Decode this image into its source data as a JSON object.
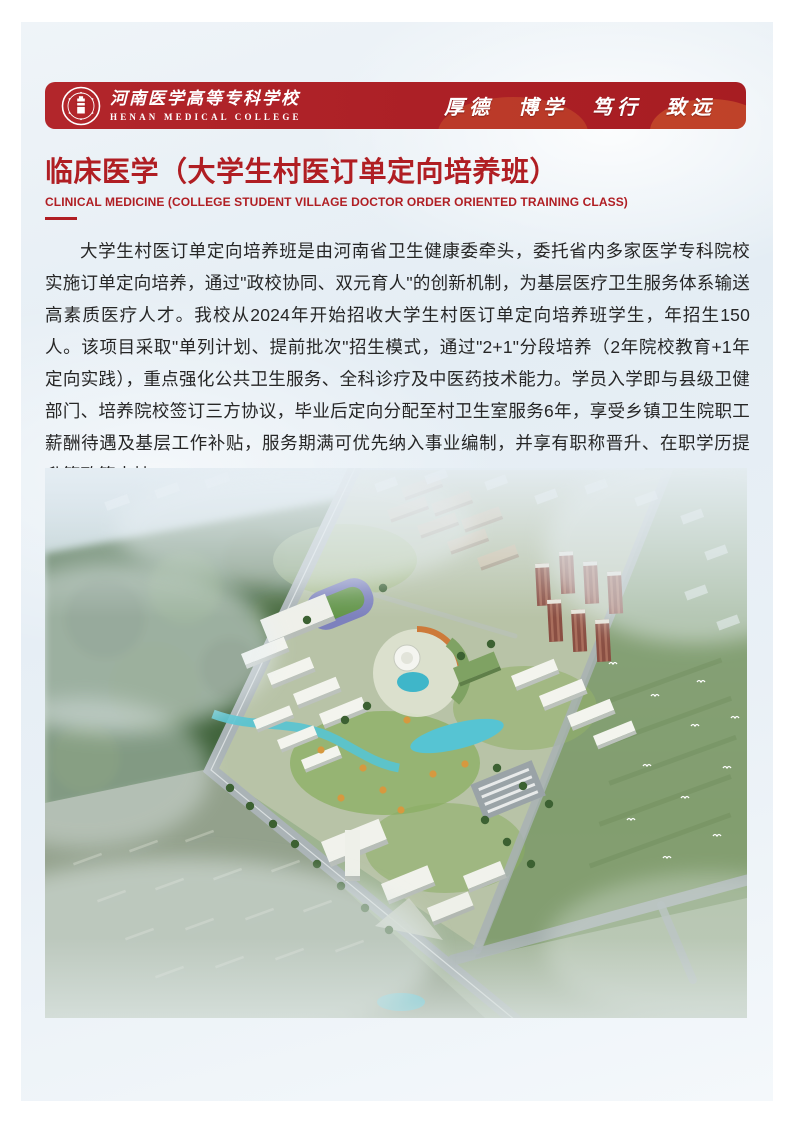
{
  "header": {
    "college_name_zh": "河南医学高等专科学校",
    "college_name_en": "HENAN MEDICAL COLLEGE",
    "motto": "厚德 博学 笃行 致远",
    "logo_icon": "college-seal-icon"
  },
  "title": {
    "zh": "临床医学（大学生村医订单定向培养班）",
    "en": "CLINICAL MEDICINE (COLLEGE STUDENT VILLAGE DOCTOR ORDER ORIENTED TRAINING CLASS)"
  },
  "body": {
    "paragraph": "大学生村医订单定向培养班是由河南省卫生健康委牵头，委托省内多家医学专科院校实施订单定向培养，通过\"政校协同、双元育人\"的创新机制，为基层医疗卫生服务体系输送高素质医疗人才。我校从2024年开始招收大学生村医订单定向培养班学生，年招生150人。该项目采取\"单列计划、提前批次\"招生模式，通过\"2+1\"分段培养（2年院校教育+1年定向实践），重点强化公共卫生服务、全科诊疗及中医药技术能力。学员入学即与县级卫健部门、培养院校签订三方协议，毕业后定向分配至村卫生室服务6年，享受乡镇卫生院职工薪酬待遇及基层工作补贴，服务期满可优先纳入事业编制，并享有职称晋升、在职学历提升等政策支持。"
  },
  "figure": {
    "name": "campus-aerial-view"
  },
  "colors": {
    "brand_red": "#AC2026",
    "title_red": "#B01E23",
    "accent_orange": "#CF5A2E",
    "body_text": "#262626",
    "page_bg": "#E9F0F6"
  }
}
